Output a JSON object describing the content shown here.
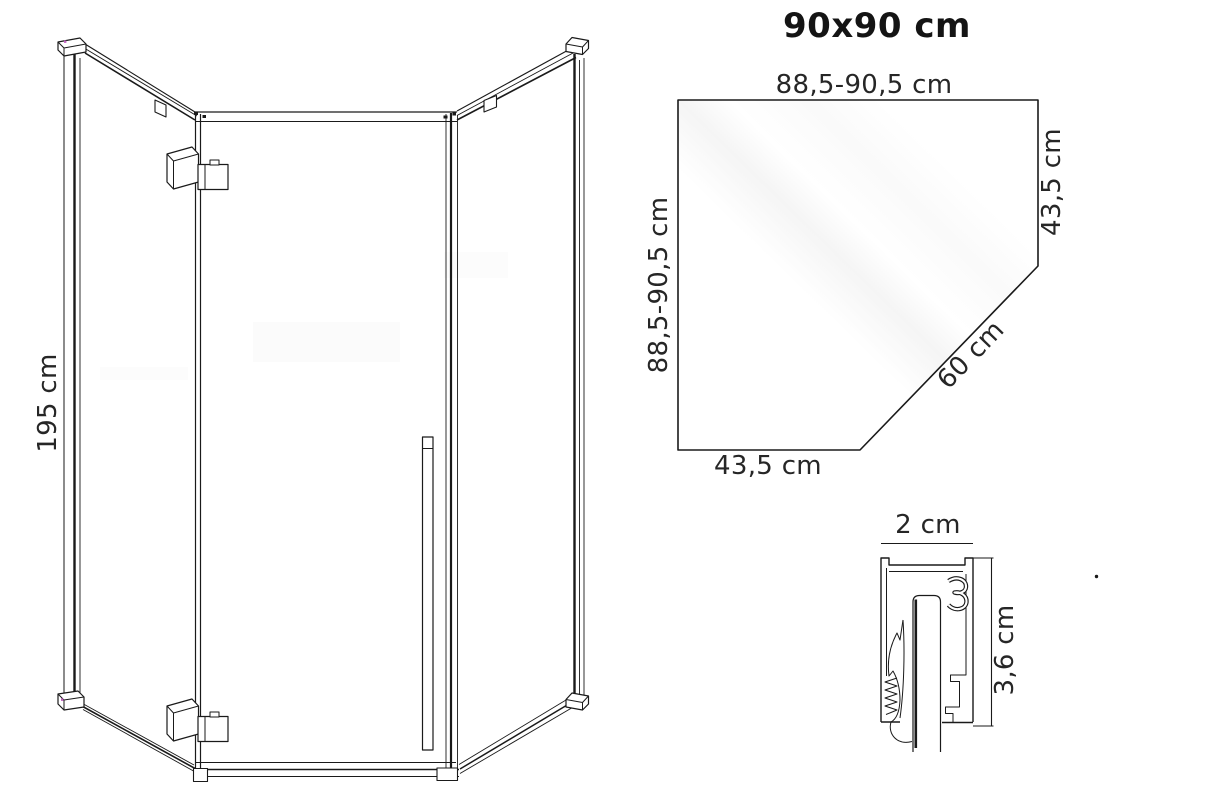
{
  "title": "90x90 cm",
  "front_view": {
    "height_label": "195 cm"
  },
  "top_view": {
    "top_width_label": "88,5-90,5 cm",
    "left_width_label": "88,5-90,5 cm",
    "right_side_label": "43,5 cm",
    "bottom_side_label": "43,5 cm",
    "diagonal_label": "60 cm"
  },
  "profile_detail": {
    "width_label": "2 cm",
    "height_label": "3,6 cm"
  },
  "colors": {
    "line": "#1a1a1a",
    "text": "#262626",
    "title_text": "#141414",
    "background": "#ffffff"
  }
}
